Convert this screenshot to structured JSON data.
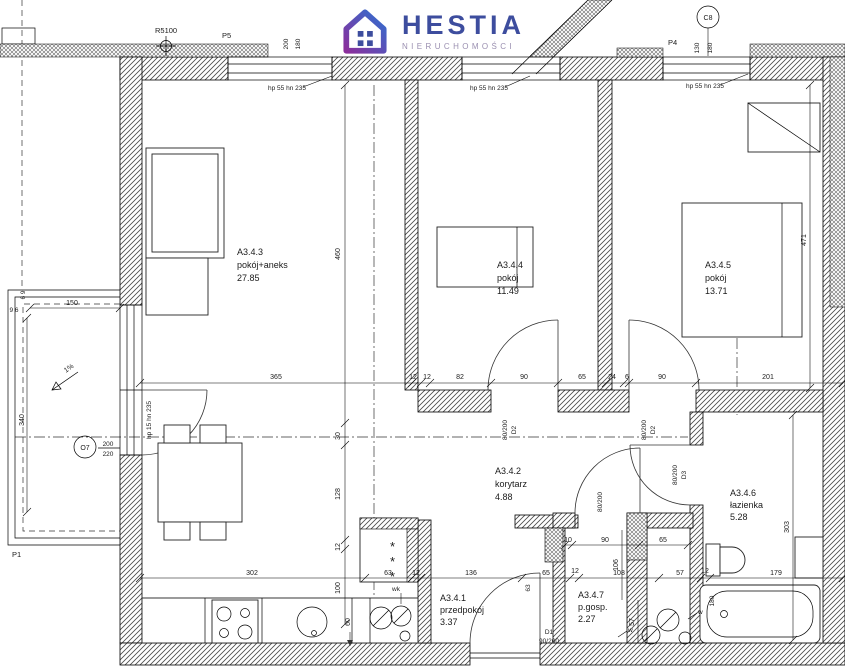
{
  "logo": {
    "brand": "HESTIA",
    "subtitle": "NIERUCHOMOŚCI",
    "brand_color": "#3d4d9e",
    "gradient_purple": "#8b2f9c",
    "gradient_blue": "#2f6fd0"
  },
  "rooms": {
    "r343": {
      "id": "A3.4.3",
      "name": "pokój+aneks",
      "area": "27.85"
    },
    "r344": {
      "id": "A3.4.4",
      "name": "pokój",
      "area": "11.49"
    },
    "r345": {
      "id": "A3.4.5",
      "name": "pokój",
      "area": "13.71"
    },
    "r342": {
      "id": "A3.4.2",
      "name": "korytarz",
      "area": "4.88"
    },
    "r346": {
      "id": "A3.4.6",
      "name": "łazienka",
      "area": "5.28"
    },
    "r341": {
      "id": "A3.4.1",
      "name": "przedpokój",
      "area": "3.37"
    },
    "r347": {
      "id": "A3.4.7",
      "name": "p.gosp.",
      "area": "2.27"
    }
  },
  "markers": {
    "r5100": "R5100",
    "p5": "P5",
    "p4": "P4",
    "p1": "P1",
    "c8": "C8",
    "slope": "1%",
    "w": "w",
    "wk": "wk"
  },
  "windows": {
    "top_note": "hp 55 hn 235",
    "balcony_note": "hp 15 hn 235"
  },
  "doors": {
    "d1": {
      "label": "D1",
      "size": "90/200"
    },
    "d2": {
      "label": "D2",
      "size": "80/200"
    },
    "d3": {
      "label": "D3",
      "size": "80/200"
    },
    "pgosp_size": "80/200",
    "balcony": {
      "label": "O7",
      "size_num": "200",
      "size_den": "220"
    }
  },
  "dims": {
    "mid_chain": [
      "365",
      "12",
      "12",
      "82",
      "90",
      "65",
      "24",
      "6",
      "90",
      "201"
    ],
    "left_col": [
      "460",
      "30",
      "128",
      "12",
      "100"
    ],
    "bottom_chain": [
      "302",
      "63",
      "12",
      "136",
      "65",
      "12",
      "108",
      "57",
      "12",
      "179"
    ],
    "bottom_extra": [
      "63",
      "180"
    ],
    "pgosp_top": [
      "10",
      "90",
      "65"
    ],
    "pgosp_side": [
      "106",
      "57"
    ],
    "bath_side": [
      "303",
      "471"
    ],
    "top_left_win": [
      "200",
      "180"
    ],
    "top_right_win": [
      "130",
      "180"
    ],
    "balcony": [
      "6 9",
      "9 6",
      "150",
      "340"
    ],
    "kitchen_depth": "60"
  },
  "symbols": {
    "wardrobe": "*"
  }
}
